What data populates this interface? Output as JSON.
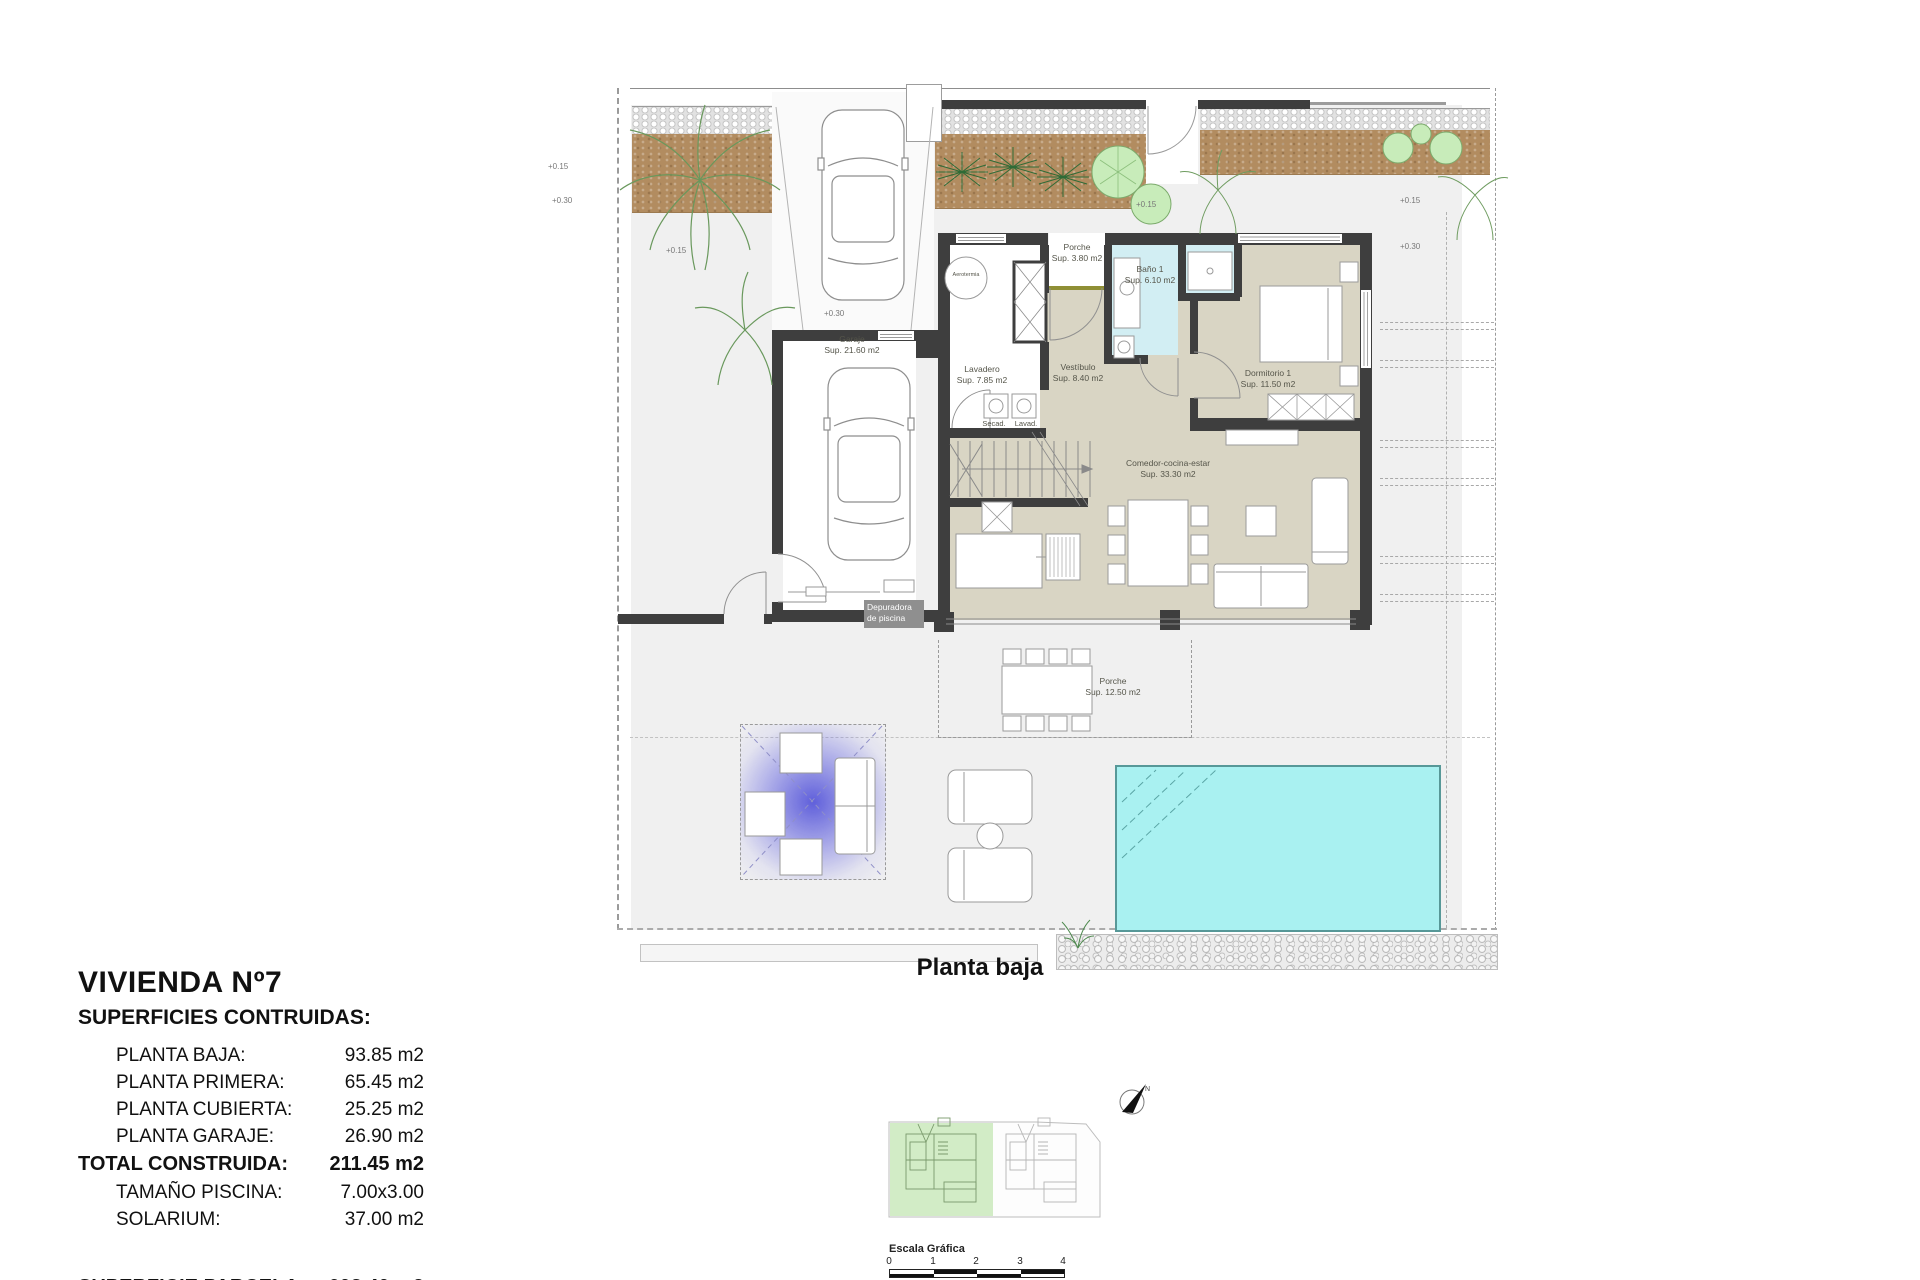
{
  "summary": {
    "title": "VIVIENDA Nº7",
    "subtitle": "SUPERFICIES CONTRUIDAS:",
    "rows": [
      {
        "label": "PLANTA BAJA:",
        "value": "93.85 m2"
      },
      {
        "label": "PLANTA PRIMERA:",
        "value": "65.45 m2"
      },
      {
        "label": "PLANTA CUBIERTA:",
        "value": "25.25 m2"
      },
      {
        "label": "PLANTA GARAJE:",
        "value": "26.90 m2"
      }
    ],
    "total": {
      "label": "TOTAL CONSTRUIDA:",
      "value": "211.45 m2"
    },
    "extras": [
      {
        "label": "TAMAÑO PISCINA:",
        "value": "7.00x3.00"
      },
      {
        "label": "SOLARIUM:",
        "value": "37.00 m2"
      }
    ],
    "parcel": {
      "label": "SUPERFICIE PARCELA:",
      "value": "608.40 m2"
    }
  },
  "plan": {
    "caption": "Planta baja",
    "rooms": {
      "garaje": {
        "name": "Garaje",
        "area": "Sup. 21.60 m2"
      },
      "lavadero": {
        "name": "Lavadero",
        "area": "Sup. 7.85 m2"
      },
      "vestibulo": {
        "name": "Vestíbulo",
        "area": "Sup. 8.40 m2"
      },
      "porche_norte": {
        "name": "Porche",
        "area": "Sup. 3.80 m2"
      },
      "bano1": {
        "name": "Baño 1",
        "area": "Sup. 6.10 m2"
      },
      "dormitorio1": {
        "name": "Dormitorio 1",
        "area": "Sup. 11.50 m2"
      },
      "comedor": {
        "name": "Comedor-cocina-estar",
        "area": "Sup. 33.30 m2"
      },
      "porche_sur": {
        "name": "Porche",
        "area": "Sup. 12.50 m2"
      }
    },
    "annotations": {
      "secadora": "Secad.",
      "lavadora": "Lavad.",
      "depuradora": "Depuradora de piscina",
      "aerotermia": "Aerotermia"
    },
    "elevations": [
      "+0.15",
      "+0.30",
      "+0.15",
      "+0.30",
      "+0.15",
      "+0.15",
      "+0.30"
    ]
  },
  "keyplan": {
    "north_label": "N",
    "scale_title": "Escala Gráfica",
    "scale_ticks": [
      "0",
      "1",
      "2",
      "3",
      "4"
    ]
  },
  "colors": {
    "wall": "#3e3e3e",
    "floor": "#d9d5c4",
    "bath": "#d2eef3",
    "pool": "#a9f1f1",
    "soil": "#b28c60",
    "pergola_glow": "#5050d8",
    "keyplan_highlight": "#cdeac0"
  }
}
